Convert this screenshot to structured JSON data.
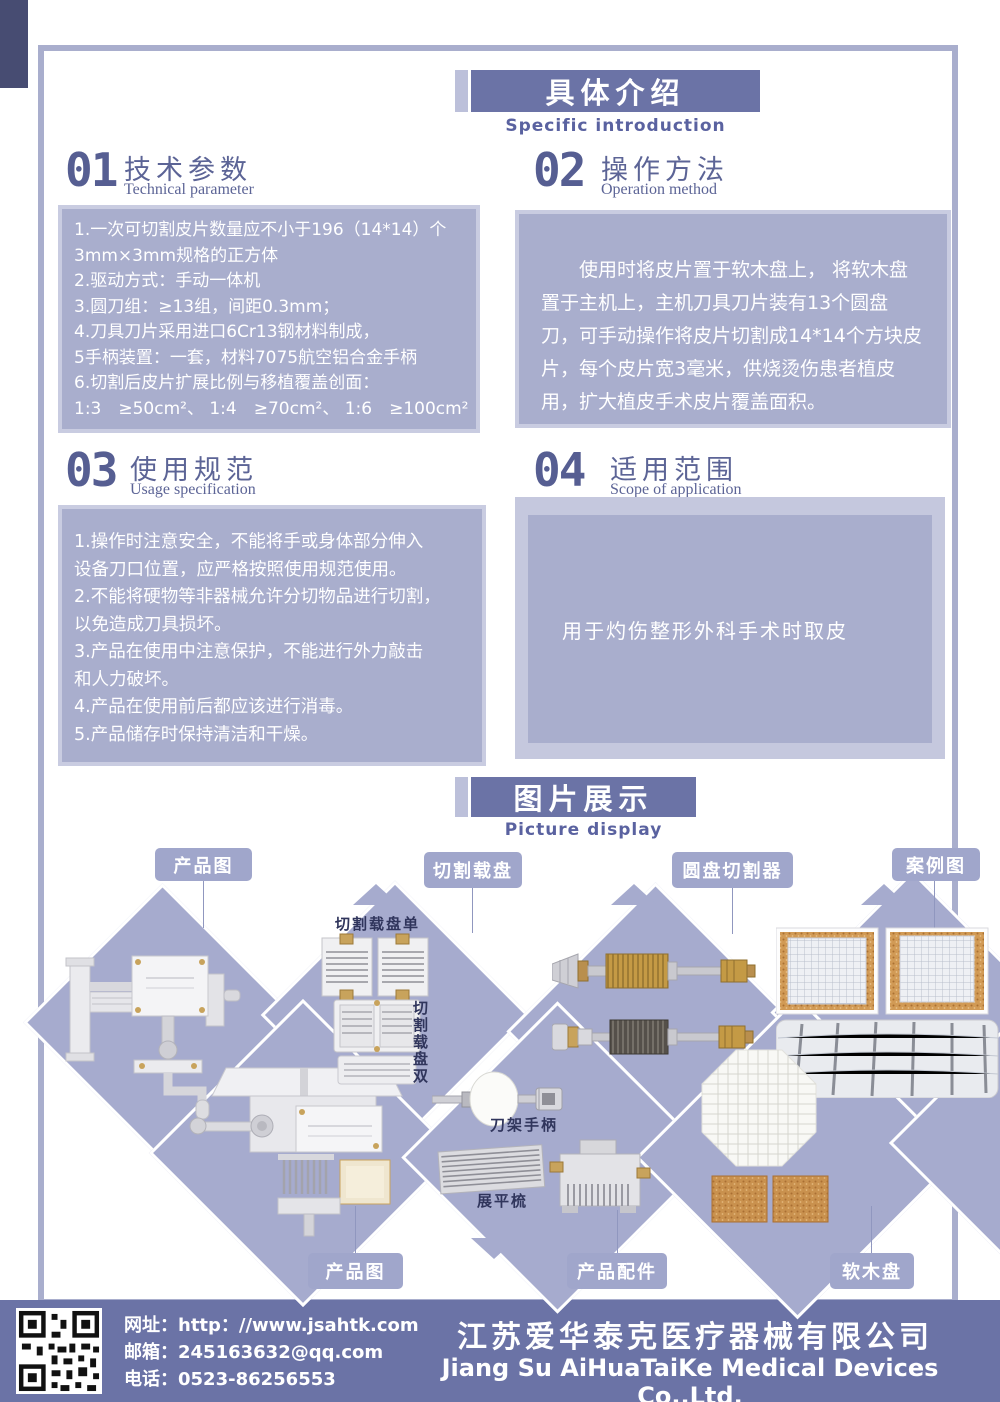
{
  "header": {
    "title": "具体介绍",
    "subtitle": "Specific introduction"
  },
  "sections": [
    {
      "num": "01",
      "title": "技术参数",
      "subtitle": "Technical parameter",
      "lines": [
        "1.一次可切割皮片数量应不小于196（14*14）个",
        "3mm×3mm规格的正方体",
        "2.驱动方式：手动一体机",
        "3.圆刀组：≥13组，间距0.3mm；",
        "4.刀具刀片采用进口6Cr13钢材料制成，",
        "5手柄装置：一套，材料7075航空铝合金手柄",
        "6.切割后皮片扩展比例与移植覆盖创面：",
        "1:3　≥50cm²、 1:4　≥70cm²、 1:6　≥100cm²"
      ]
    },
    {
      "num": "02",
      "title": "操作方法",
      "subtitle": "Operation method",
      "paragraph": "使用时将皮片置于软木盘上， 将软木盘置于主机上，主机刀具刀片装有13个圆盘刀，可手动操作将皮片切割成14*14个方块皮片，每个皮片宽3毫米，供烧烫伤患者植皮用，扩大植皮手术皮片覆盖面积。"
    },
    {
      "num": "03",
      "title": "使用规范",
      "subtitle": "Usage specification",
      "lines": [
        "1.操作时注意安全，不能将手或身体部分伸入",
        "设备刀口位置，应严格按照使用规范使用。",
        "2.不能将硬物等非器械允许分切物品进行切割，",
        "以免造成刀具损坏。",
        "3.产品在使用中注意保护，不能进行外力敲击",
        "和人力破坏。",
        "4.产品在使用前后都应该进行消毒。",
        "5.产品储存时保持清洁和干燥。"
      ]
    },
    {
      "num": "04",
      "title": "适用范围",
      "subtitle": "Scope of application",
      "paragraph": "用于灼伤整形外科手术时取皮"
    }
  ],
  "gallery": {
    "title": "图片展示",
    "subtitle": "Picture display",
    "labels_top": [
      "产品图",
      "切割载盘",
      "圆盘切割器",
      "案例图"
    ],
    "labels_bottom": [
      "产品图",
      "产品配件",
      "软木盘"
    ],
    "inner_labels": {
      "tray_single": "切割载盘单",
      "tray_double": "切割载盘双",
      "handle": "刀架手柄",
      "comb": "展平梳"
    }
  },
  "footer": {
    "website_label": "网址：",
    "website": "http：//www.jsahtk.com",
    "email_label": "邮箱：",
    "email": "245163632@qq.com",
    "phone_label": "电话：",
    "phone": "0523-86256553",
    "company_cn": "江苏爱华泰克医疗器械有限公司",
    "company_en": "Jiang Su AiHuaTaiKe Medical Devices Co.,Ltd."
  },
  "colors": {
    "accent_dark": "#6b73a6",
    "accent_mid": "#a6abce",
    "accent_light": "#c9cce1",
    "box_fill": "#a9aecd",
    "title_text": "#5c6496",
    "gold": "#c8a35c",
    "cork": "#c9914e"
  }
}
